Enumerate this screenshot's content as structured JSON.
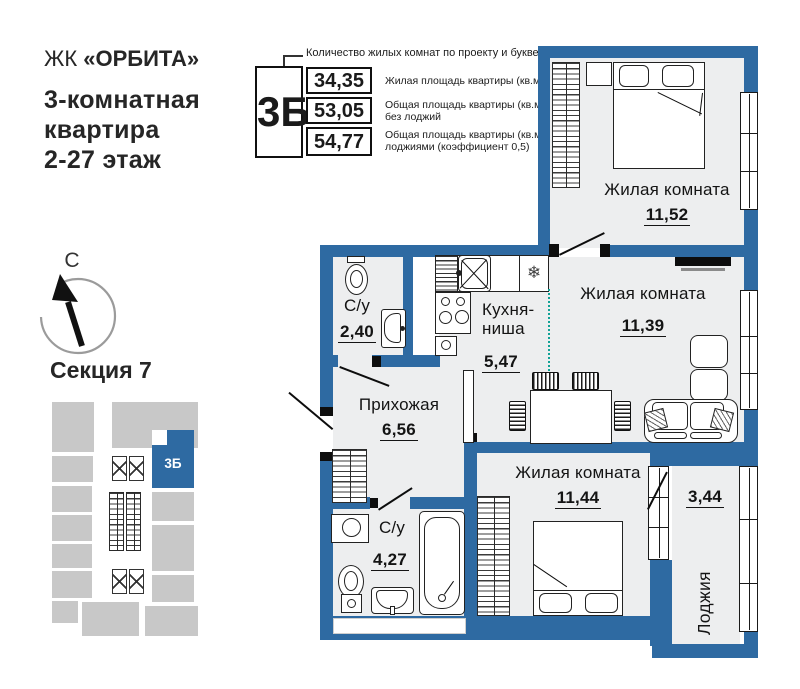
{
  "header": {
    "brand_prefix": "ЖК",
    "brand_name": "«ОРБИТА»",
    "line1": "3-комнатная",
    "line2": "квартира",
    "line3": "2-27 этаж"
  },
  "spec": {
    "callout": "Количество жилых комнат по проекту и буквенный код",
    "code": "3Б",
    "rows": [
      {
        "value": "34,35",
        "label": "Жилая площадь квартиры (кв.м)"
      },
      {
        "value": "53,05",
        "label": "Общая площадь квартиры (кв.м) без лоджий"
      },
      {
        "value": "54,77",
        "label": "Общая площадь квартиры (кв.м) с лоджиями (коэффициент 0,5)"
      }
    ]
  },
  "compass": {
    "north": "С"
  },
  "section": {
    "title": "Секция 7",
    "unit": "3Б"
  },
  "plan": {
    "rooms": {
      "r1152": {
        "name": "Жилая комната",
        "area": "11,52"
      },
      "r1139": {
        "name": "Жилая комната",
        "area": "11,39"
      },
      "kitchen": {
        "name": "Кухня-ниша",
        "area": "5,47"
      },
      "su1": {
        "name": "С/у",
        "area": "2,40"
      },
      "hall": {
        "name": "Прихожая",
        "area": "6,56"
      },
      "r1144": {
        "name": "Жилая комната",
        "area": "11,44"
      },
      "su2": {
        "name": "С/у",
        "area": "4,27"
      },
      "loggia": {
        "name": "Лоджия",
        "area": "3,44"
      }
    },
    "icons": {
      "vent": "❄"
    },
    "colors": {
      "wall": "#2e6aa2",
      "floor": "#edeeef",
      "section_block": "#c8c8c8",
      "divider": "#12a296"
    }
  }
}
